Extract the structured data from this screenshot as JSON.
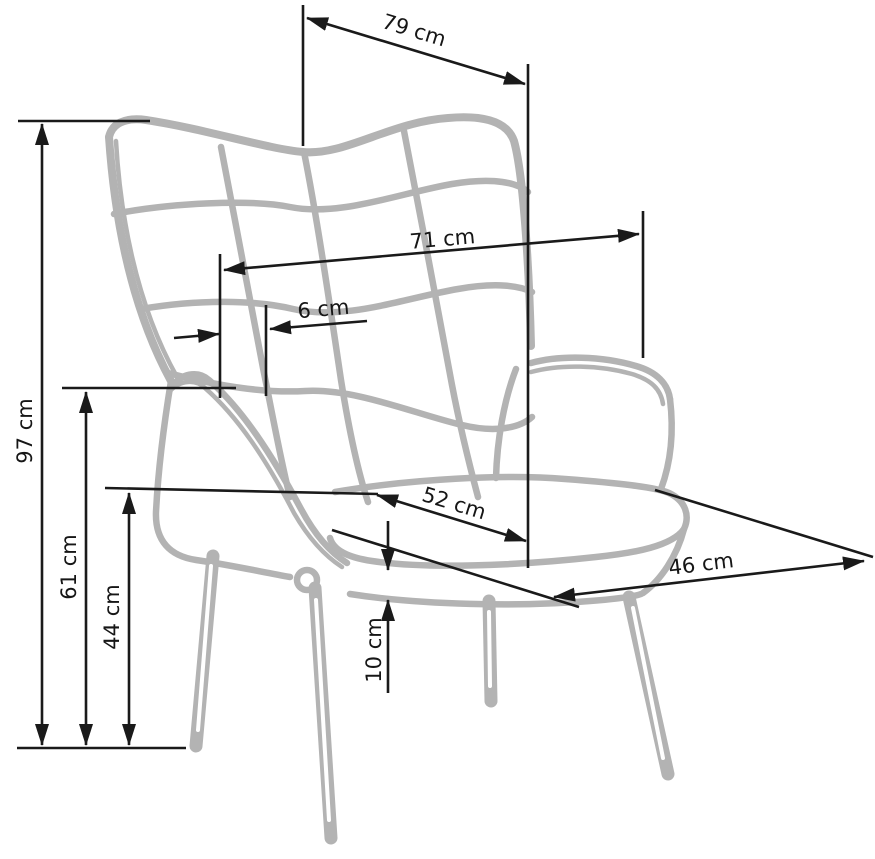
{
  "diagram": {
    "subject": "wingback armchair line drawing with dimensions",
    "unit": "cm",
    "dimensions": {
      "d79": {
        "label": "79 cm",
        "value": 79
      },
      "d71": {
        "label": "71 cm",
        "value": 71
      },
      "d6": {
        "label": "6 cm",
        "value": 6
      },
      "d97": {
        "label": "97 cm",
        "value": 97
      },
      "d61": {
        "label": "61 cm",
        "value": 61
      },
      "d44": {
        "label": "44 cm",
        "value": 44
      },
      "d52": {
        "label": "52 cm",
        "value": 52
      },
      "d46": {
        "label": "46 cm",
        "value": 46
      },
      "d10": {
        "label": "10 cm",
        "value": 10
      }
    },
    "colors": {
      "background": "#ffffff",
      "chair_line_art": "#b3b3b3",
      "dimension_lines": "#1a1a1a"
    }
  }
}
